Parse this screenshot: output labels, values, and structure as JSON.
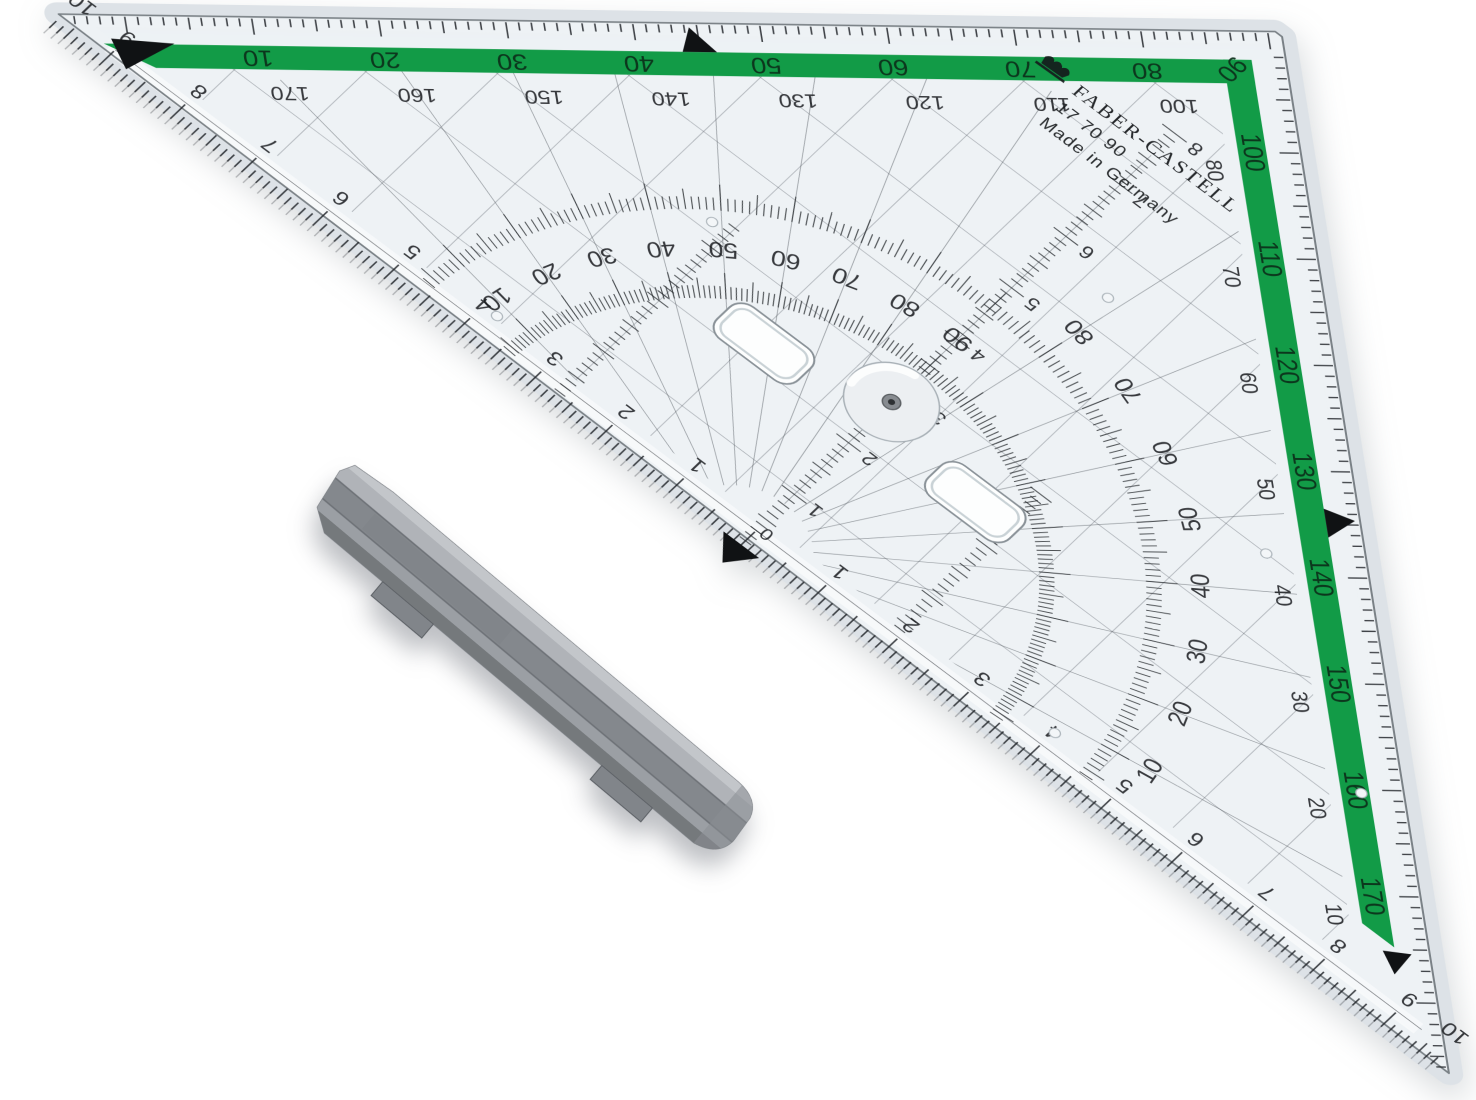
{
  "background": "#ffffff",
  "product": {
    "brand": "FABER-CASTELL",
    "model": "17 70 90",
    "origin": "Made in Germany"
  },
  "ruler": {
    "colors": {
      "green_stripe": "#129b47",
      "body": "#eef2f6",
      "bevel": "#dde2e7",
      "marking": "#22262a"
    },
    "green_scale": {
      "top": [
        "10",
        "20",
        "30",
        "40",
        "50",
        "60",
        "70",
        "80",
        "90"
      ],
      "right": [
        "100",
        "110",
        "120",
        "130",
        "140",
        "150",
        "160",
        "170"
      ]
    },
    "complement_scale": {
      "top": [
        "170",
        "160",
        "150",
        "140",
        "130",
        "120",
        "110",
        "100"
      ],
      "right": [
        "80",
        "70",
        "60",
        "50",
        "40",
        "30",
        "20",
        "10"
      ]
    },
    "protractor": {
      "inner": [
        "10",
        "20",
        "30",
        "40",
        "50",
        "60",
        "70",
        "80",
        "90"
      ],
      "outer": [
        "80",
        "70",
        "60",
        "50",
        "40",
        "30",
        "20",
        "10"
      ]
    },
    "hypotenuse_cm": {
      "left": [
        "10",
        "9",
        "8",
        "7",
        "6",
        "5",
        "4",
        "3",
        "2",
        "1"
      ],
      "zero": "0",
      "right": [
        "1",
        "2",
        "3",
        "4",
        "5",
        "6",
        "7",
        "8",
        "9",
        "10"
      ]
    },
    "altitude_cm": [
      "1",
      "2",
      "3",
      "4",
      "5",
      "6",
      "7",
      "8"
    ]
  },
  "handle": {
    "colors": {
      "top_ridge": "#b6b9bd",
      "body": "#9ca0a5",
      "groove": "#84888d",
      "bottom": "#73777c"
    }
  }
}
